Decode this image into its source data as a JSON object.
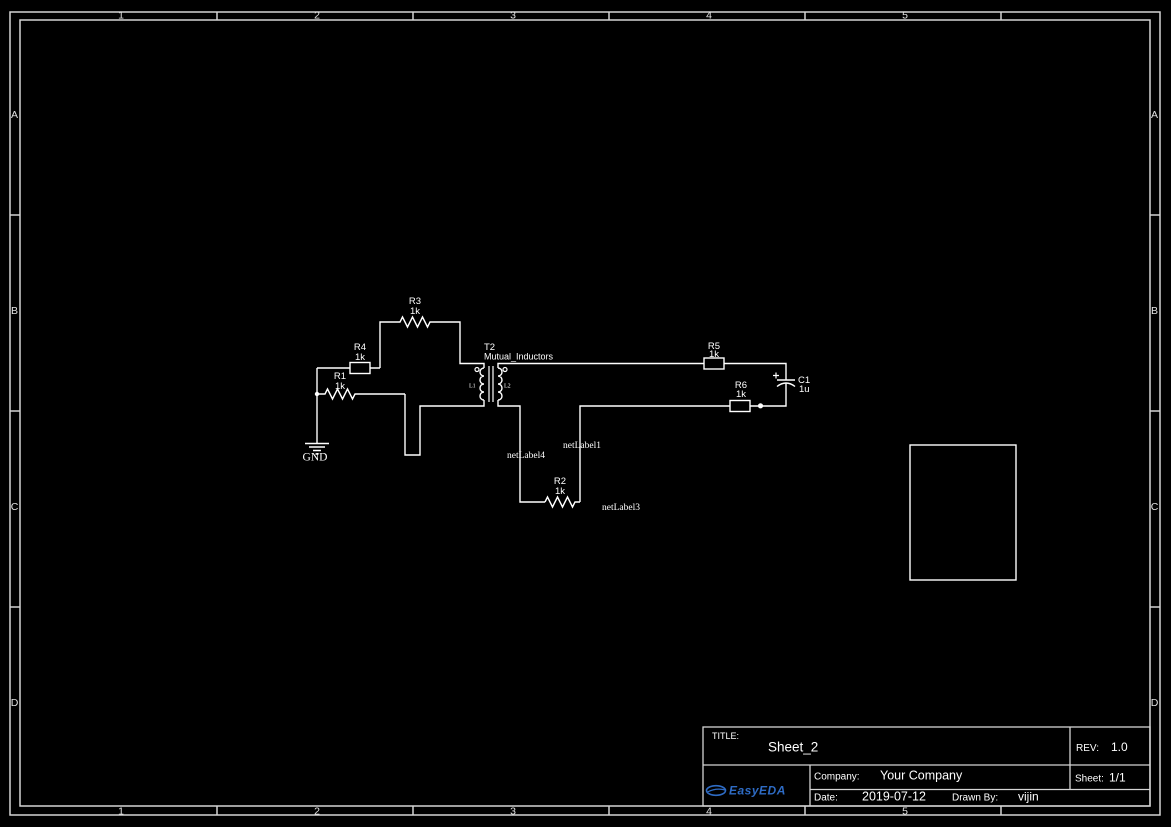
{
  "canvas": {
    "background": "#000000",
    "frame_color": "#d4d4d4",
    "wire_color": "#ffffff"
  },
  "ruler": {
    "cols": [
      "1",
      "2",
      "3",
      "4",
      "5"
    ],
    "rows": [
      "A",
      "B",
      "C",
      "D"
    ]
  },
  "schematic": {
    "components": {
      "R1": {
        "ref": "R1",
        "value": "1k"
      },
      "R2": {
        "ref": "R2",
        "value": "1k"
      },
      "R3": {
        "ref": "R3",
        "value": "1k"
      },
      "R4": {
        "ref": "R4",
        "value": "1k"
      },
      "R5": {
        "ref": "R5",
        "value": "1k"
      },
      "R6": {
        "ref": "R6",
        "value": "1k"
      },
      "C1": {
        "ref": "C1",
        "value": "1u"
      },
      "T2": {
        "ref": "T2",
        "name": "Mutual_Inductors",
        "winding1": "L1",
        "winding2": "L2"
      }
    },
    "net_labels": {
      "label1": "netLabel1",
      "label3": "netLabel3",
      "label4": "netLabel4"
    },
    "ground": "GND"
  },
  "title_block": {
    "title_label": "TITLE:",
    "title": "Sheet_2",
    "rev_label": "REV:",
    "rev": "1.0",
    "company_label": "Company:",
    "company": "Your Company",
    "sheet_label": "Sheet:",
    "sheet": "1/1",
    "date_label": "Date:",
    "date": "2019-07-12",
    "drawn_by_label": "Drawn By:",
    "drawn_by": "vijin",
    "logo_text": "EasyEDA",
    "logo_color": "#2e6bc4"
  }
}
